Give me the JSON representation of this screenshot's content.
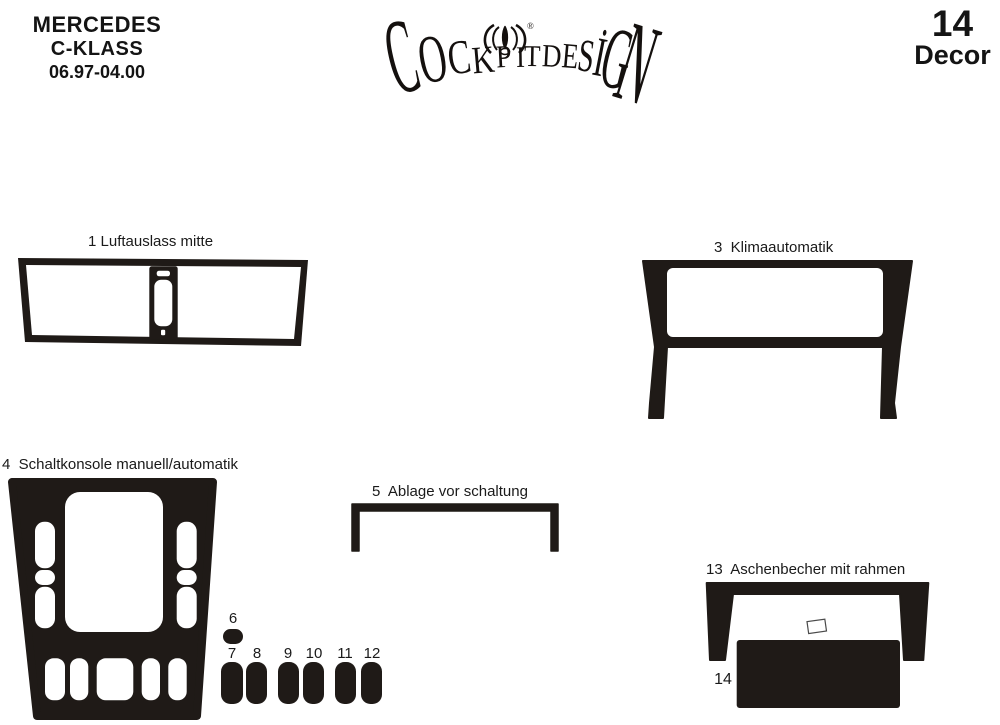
{
  "header": {
    "brand": {
      "line1": "MERCEDES",
      "line2": "C-KLASS",
      "line3": "06.97-04.00"
    },
    "logo": {
      "letters": [
        "C",
        "O",
        "C",
        "K",
        "P",
        "I",
        "T",
        "D",
        "E",
        "S",
        "İ",
        "G",
        "N"
      ],
      "registered": "®"
    },
    "kit": {
      "count": "14",
      "label": "Decor"
    }
  },
  "parts": {
    "p1": {
      "label": "1 Luftauslass mitte"
    },
    "p2": {
      "label": "2"
    },
    "p3": {
      "label": "3  Klimaautomatik"
    },
    "p4": {
      "label": "4  Schaltkonsole manuell/automatik"
    },
    "p5": {
      "label": "5  Ablage vor schaltung"
    },
    "p6": {
      "label": "6"
    },
    "p7": {
      "label": "7"
    },
    "p8": {
      "label": "8"
    },
    "p9": {
      "label": "9"
    },
    "p10": {
      "label": "10"
    },
    "p11": {
      "label": "11"
    },
    "p12": {
      "label": "12"
    },
    "p13": {
      "label": "13  Aschenbecher mit rahmen"
    },
    "p14": {
      "label": "14"
    }
  },
  "colors": {
    "piece": "#1f1a17",
    "text": "#1a1a1a",
    "background": "#ffffff"
  }
}
